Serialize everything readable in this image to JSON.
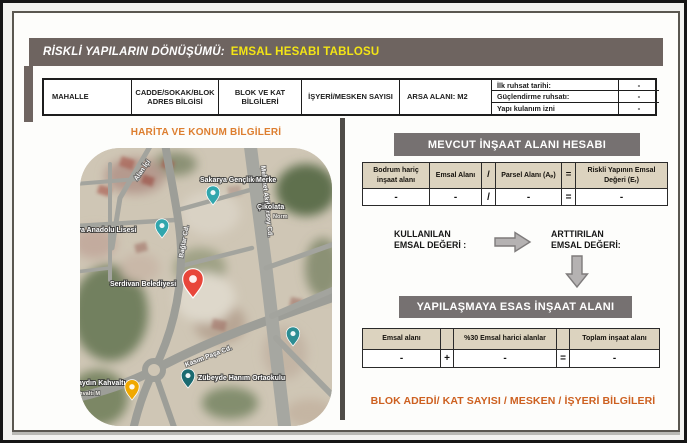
{
  "title": {
    "prefix": "RİSKLİ YAPILARIN DÖNÜŞÜMÜ:",
    "highlight": "EMSAL HESABI TABLOSU"
  },
  "info_table": {
    "columns": [
      "MAHALLE",
      "CADDE/SOKAK/BLOK ADRES BİLGİSİ",
      "BLOK VE KAT BİLGİLERİ",
      "İŞYERİ/MESKEN SAYISI",
      "ARSA ALANI: M2"
    ],
    "permits": [
      {
        "label": "İlk ruhsat tarihi:",
        "value": "-"
      },
      {
        "label": "Güçlendirme ruhsatı:",
        "value": "-"
      },
      {
        "label": "Yapı kulanım izni",
        "value": "-"
      }
    ]
  },
  "map_section": {
    "title": "HARİTA VE KONUM BİLGİLERİ",
    "streets": {
      "alan": "Alan İçi",
      "baglar": "Bağlar Cd.",
      "mehmet_akif": "Mehmet Akif Ersoy Cd.",
      "kasim_pasa": "Kasım Paşa Cd."
    },
    "pois": {
      "genclik": "Sakarya Gençlik Merke",
      "cikolata": "Çikolata",
      "cikolata_sub": "Norm",
      "lisesi": "Sakarya Anadolu Lisesi",
      "belediye": "Serdivan Belediyesi",
      "ortaokul": "Zübeyde Hanım Ortaokulu",
      "kahvalti": "Günaydın Kahvaltı",
      "kahvalti_sub": "Kahvaltı M"
    }
  },
  "mevcut": {
    "title": "MEVCUT İNŞAAT ALANI HESABI",
    "headers": [
      "Bodrum hariç inşaat alanı",
      "Emsal Alanı",
      "/",
      "Parsel Alanı (Aₚ)",
      "=",
      "Riskli Yapının Emsal Değeri (Eᵣ)"
    ],
    "values": [
      "-",
      "-",
      "/",
      "-",
      "=",
      "-"
    ]
  },
  "emsal_flow": {
    "used_line1": "KULLANILAN",
    "used_line2": "EMSAL DEĞERİ :",
    "increased_line1": "ARTTIRILAN",
    "increased_line2": "EMSAL DEĞERİ:"
  },
  "yapilasma": {
    "title": "YAPILAŞMAYA ESAS İNŞAAT ALANI",
    "headers": [
      "Emsal alanı",
      "",
      "%30 Emsal harici alanlar",
      "",
      "Toplam inşaat alanı"
    ],
    "values": [
      "-",
      "+",
      "-",
      "=",
      "-"
    ]
  },
  "footer": {
    "text": "BLOK ADEDİ/ KAT SAYISI / MESKEN / İŞYERİ BİLGİLERİ"
  },
  "colors": {
    "title_bg": "#6e6460",
    "title_highlight": "#f3e515",
    "section_bar_bg": "#767171",
    "orange_heading": "#dd7e2f",
    "footer_orange": "#cd6020",
    "table_header_beige": "#dcd3bf",
    "red_pin": "#e8463a",
    "teal_pin": "#31a6ad",
    "yellow_pin": "#f0a800"
  }
}
